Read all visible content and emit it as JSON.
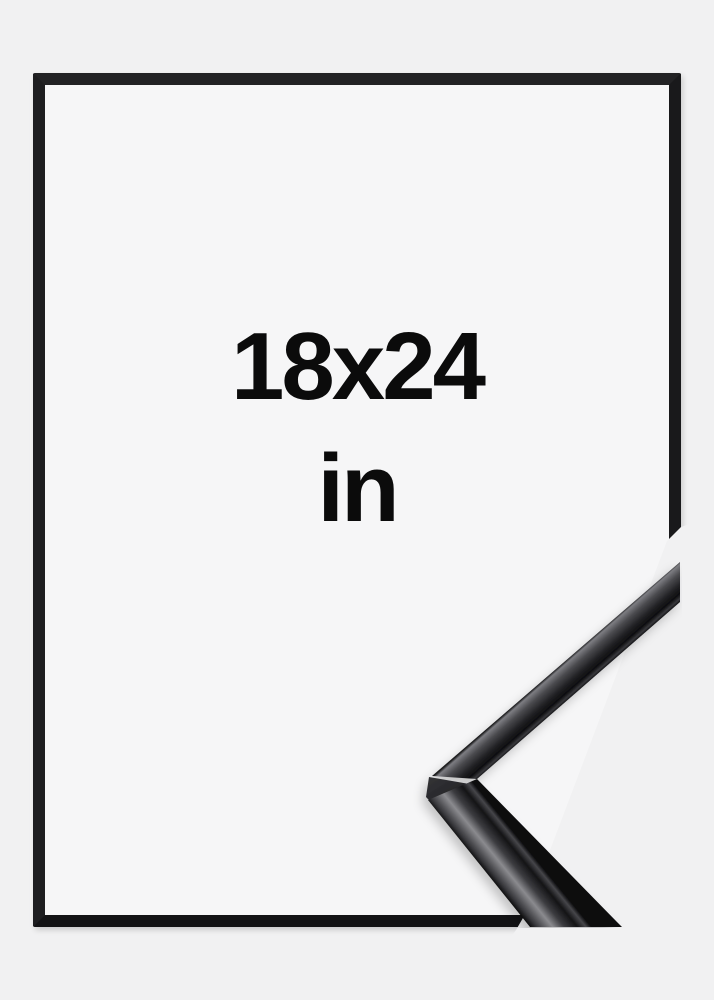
{
  "product_mockup": {
    "size_label": "18x24",
    "unit_label": "in"
  },
  "colors": {
    "background": "#f1f1f2",
    "frame_black": "#1a1a1c",
    "moulding_highlight": "#8a8a8e",
    "text": "#0b0b0b"
  }
}
